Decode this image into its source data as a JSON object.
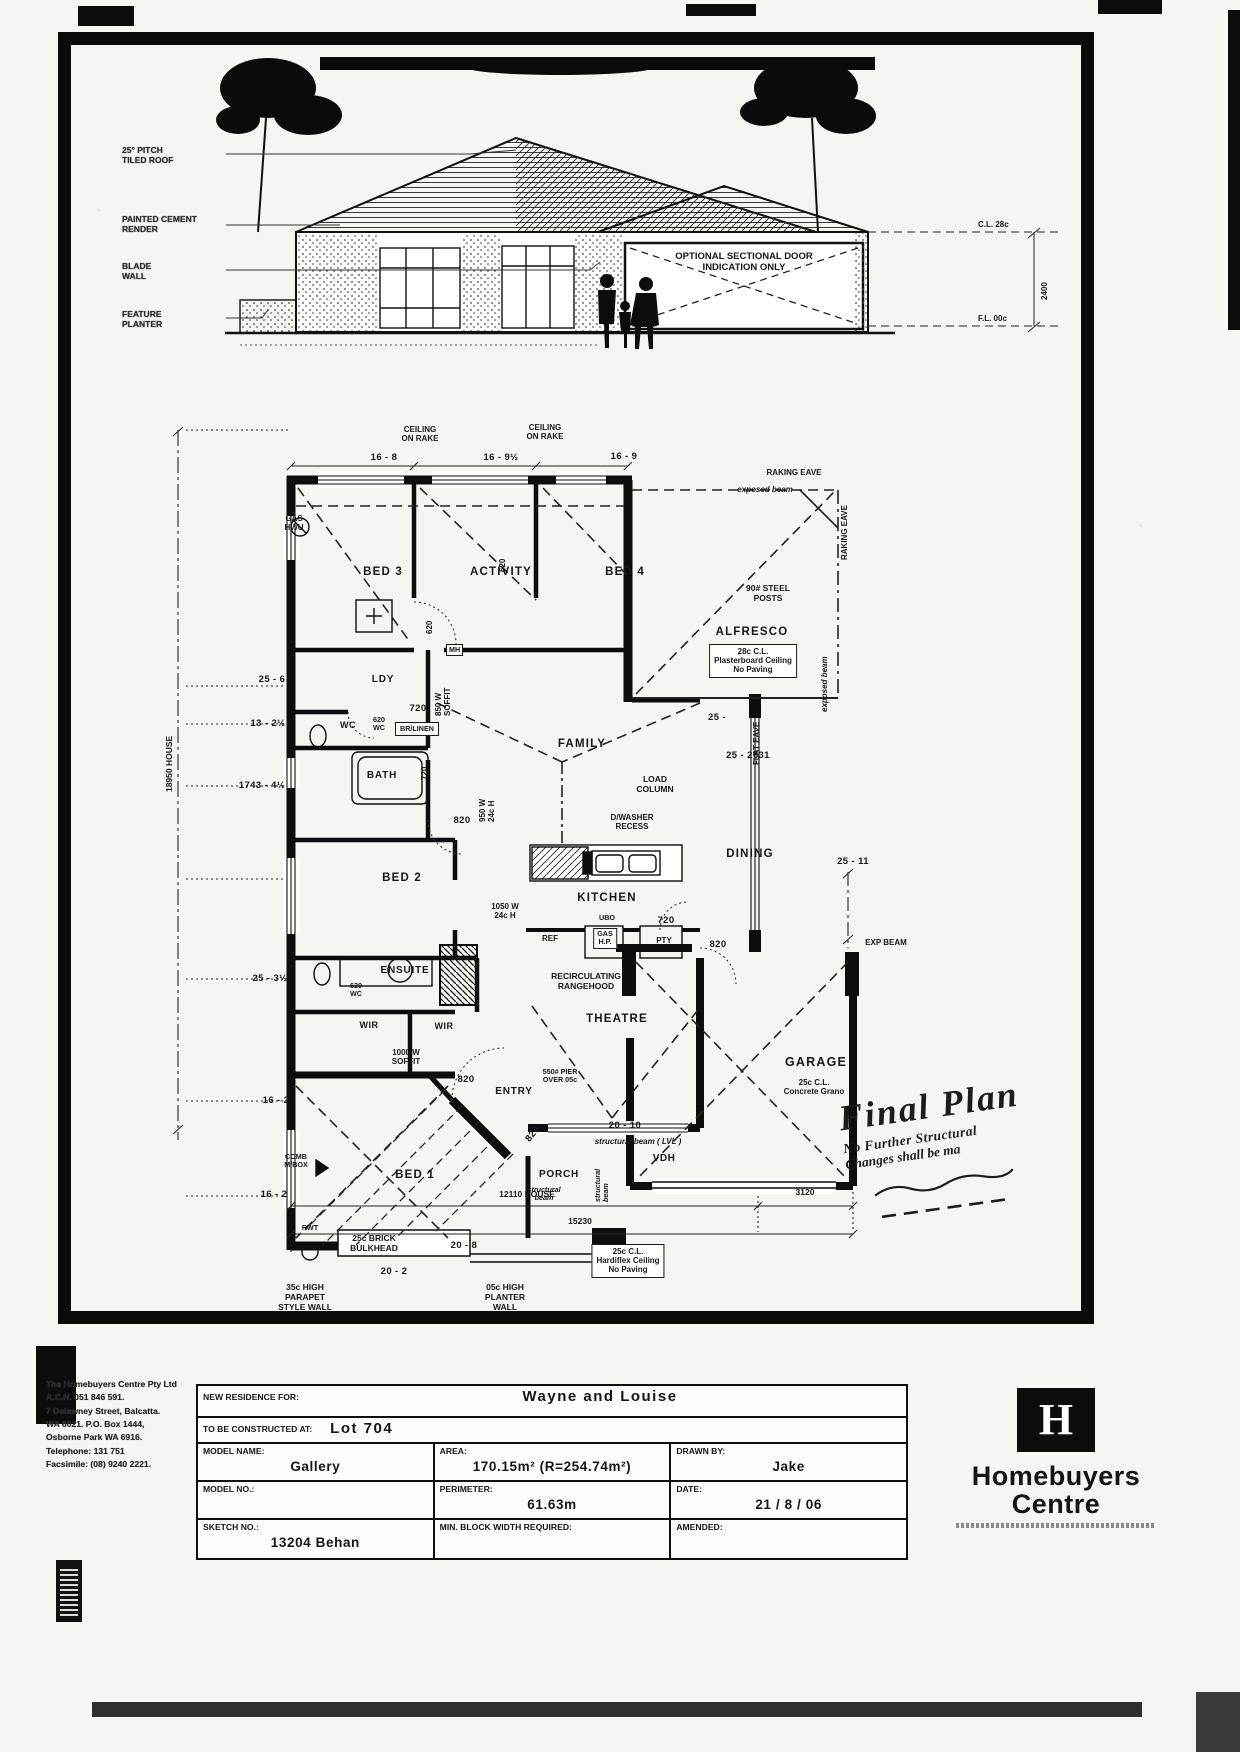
{
  "elevation": {
    "labels": {
      "pitch": "25° PITCH\nTILED ROOF",
      "render": "PAINTED CEMENT\nRENDER",
      "blade": "BLADE\nWALL",
      "planter": "FEATURE\nPLANTER",
      "garage_door_note": "OPTIONAL SECTIONAL DOOR\nINDICATION ONLY",
      "ceiling_level": "C.L. 28c",
      "height": "2400",
      "floor_level": "F.L. 00c"
    }
  },
  "plan": {
    "labels": {
      "rake1": "CEILING\nON RAKE",
      "rake2": "CEILING\nON RAKE",
      "dim_top1": "16 - 8",
      "dim_top2": "16 - 9½",
      "dim_top3": "16 - 9",
      "raking_eave_h": "RAKING EAVE",
      "exposed_beam_h": "exposed beam",
      "raking_eave_v": "RAKING EAVE",
      "gas_hwu": "GAS\nHWU",
      "bed3": "BED 3",
      "activity": "ACTIVITY",
      "bed4": "BED 4",
      "steel_posts": "90# STEEL\nPOSTS",
      "alfresco": "ALFRESCO",
      "alfresco_note": "28c C.L.\nPlasterboard Ceiling\nNo Paving",
      "door620_a": "620",
      "door620_b": "620",
      "dim_l1": "25 - 6",
      "ldy": "LDY",
      "mh": "MH",
      "soffit850": "850 W\nSOFFIT",
      "door720_a": "720",
      "br_linen": "BR/LINEN",
      "dim_l2": "13 - 2½",
      "wc1": "WC",
      "wc1_door": "620\nWC",
      "bath": "BATH",
      "door720_v": "720",
      "dim_l3": "1743 - 4½",
      "door820_a": "820",
      "w950": "950 W\n24c H",
      "family": "FAMILY",
      "load_column": "LOAD\nCOLUMN",
      "dim_25": "25 -",
      "dim_2631": "25 - 2631",
      "exposed_beam_v": "exposed beam",
      "flat_eave": "FLAT EAVE",
      "dwasher": "D/WASHER\nRECESS",
      "dining": "DINING",
      "dim_2511": "25 - 11",
      "bed2": "BED 2",
      "w1050": "1050 W\n24c H",
      "kitchen": "KITCHEN",
      "ubo": "UBO",
      "gas_hp": "GAS\nH.P.",
      "ref": "REF",
      "door720_b": "720",
      "pty": "PTY",
      "door820_b": "820",
      "rangehood": "RECIRCULATING\nRANGEHOOD",
      "theatre": "THEATRE",
      "exp_beam": "EXP BEAM",
      "garage": "GARAGE",
      "garage_note": "25c C.L.\nConcrete Grano",
      "dim_l4": "25 - 3½",
      "ensuite": "ENSUITE",
      "wc2_door": "620\nWC",
      "wir1": "WIR",
      "wir2": "WIR",
      "soffit1000": "1000 W\nSOFFIT",
      "dim_l5": "16 - 2",
      "door820_c": "820",
      "entry": "ENTRY",
      "door820_d": "820",
      "mbox": "COMB\nM/BOX",
      "dim_2010": "20 - 10",
      "lvl_beam": "structural beam ( LVL )",
      "vdh": "VDH",
      "porch": "PORCH",
      "struct_beam_h": "structural\nbeam",
      "struct_beam_v": "structural\nbeam",
      "pier": "550# PIER\nOVER 05c",
      "dim_l6": "16 - 2",
      "bed1": "BED 1",
      "rwt": "RWT",
      "bulkhead": "25c BRICK\nBULKHEAD",
      "dim_208": "20 - 8",
      "dim_202": "20 - 2",
      "parapet": "35c HIGH\nPARAPET\nSTYLE WALL",
      "planter_wall": "05c HIGH\nPLANTER\nWALL",
      "porch_note": "25c C.L.\nHardiflex Ceiling\nNo Paving",
      "dim_12110": "12110 HOUSE",
      "dim_3120": "3120",
      "dim_15230": "15230",
      "dim_18950": "18950 HOUSE"
    }
  },
  "stamp": {
    "line1": "Final Plan",
    "line2": "No Further Structural",
    "line3": "Changes shall be ma"
  },
  "title_block": {
    "company_lines": [
      "The Homebuyers Centre Pty Ltd",
      "A.C.N. 051 846 591.",
      "7 Delawney Street, Balcatta.",
      "WA 6021. P.O. Box 1444,",
      "Osborne Park WA 6916.",
      "Telephone: 131 751",
      "Facsimile: (08) 9240 2221."
    ],
    "rows": {
      "residence_label": "NEW RESIDENCE FOR:",
      "residence_value": "Wayne and Louise",
      "constructed_label": "TO BE CONSTRUCTED AT:",
      "constructed_value": "Lot 704",
      "model_name_label": "MODEL NAME:",
      "model_name_value": "Gallery",
      "area_label": "AREA:",
      "area_value": "170.15m² (R=254.74m²)",
      "drawn_by_label": "DRAWN BY:",
      "drawn_by_value": "Jake",
      "model_no_label": "MODEL NO.:",
      "model_no_value": "",
      "perimeter_label": "PERIMETER:",
      "perimeter_value": "61.63m",
      "date_label": "DATE:",
      "date_value": "21 / 8 / 06",
      "sketch_label": "SKETCH NO.:",
      "sketch_value": "13204 Behan",
      "min_block_label": "MIN. BLOCK WIDTH REQUIRED:",
      "min_block_value": "",
      "amended_label": "AMENDED:",
      "amended_value": ""
    },
    "logo": {
      "monogram": "H",
      "name1": "Homebuyers",
      "name2": "Centre"
    }
  }
}
